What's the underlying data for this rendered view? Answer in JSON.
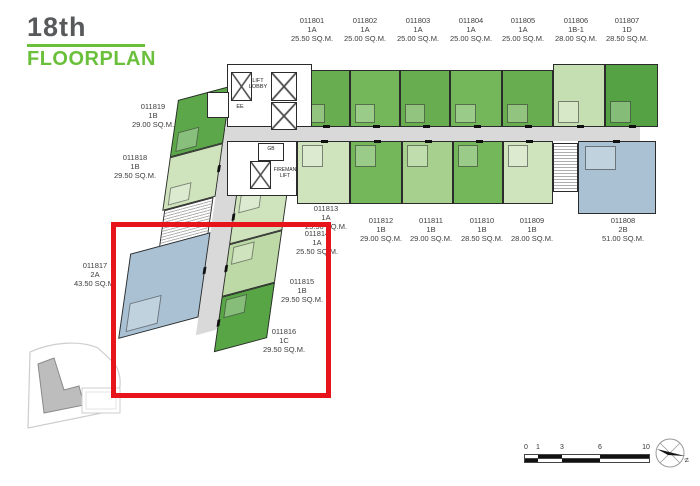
{
  "title": {
    "floor": "18th",
    "label": "FLOORPLAN"
  },
  "palette": {
    "highlight_red": "#e8141c",
    "brand_green": "#6abf3b",
    "title_gray": "#58595b",
    "unit_green_dark": "#5ca74a",
    "unit_green_mid": "#74b75a",
    "unit_green_pale": "#cfe4bd",
    "unit_blue_gray": "#a9c1d3",
    "corridor_gray": "#d9d9d9"
  },
  "units": [
    {
      "id": "011801",
      "type": "1A",
      "area": "25.50 SQ.M."
    },
    {
      "id": "011802",
      "type": "1A",
      "area": "25.00 SQ.M."
    },
    {
      "id": "011803",
      "type": "1A",
      "area": "25.00 SQ.M."
    },
    {
      "id": "011804",
      "type": "1A",
      "area": "25.00 SQ.M."
    },
    {
      "id": "011805",
      "type": "1A",
      "area": "25.00 SQ.M."
    },
    {
      "id": "011806",
      "type": "1B-1",
      "area": "28.00 SQ.M."
    },
    {
      "id": "011807",
      "type": "1D",
      "area": "28.50 SQ.M."
    },
    {
      "id": "011808",
      "type": "2B",
      "area": "51.00 SQ.M."
    },
    {
      "id": "011809",
      "type": "1B",
      "area": "28.00 SQ.M."
    },
    {
      "id": "011810",
      "type": "1B",
      "area": "28.50 SQ.M."
    },
    {
      "id": "011811",
      "type": "1B",
      "area": "29.00 SQ.M."
    },
    {
      "id": "011812",
      "type": "1B",
      "area": "29.00 SQ.M."
    },
    {
      "id": "011813",
      "type": "1A",
      "area": "25.50 SQ.M."
    },
    {
      "id": "011814",
      "type": "1A",
      "area": "25.50 SQ.M."
    },
    {
      "id": "011815",
      "type": "1B",
      "area": "29.50 SQ.M."
    },
    {
      "id": "011816",
      "type": "1C",
      "area": "29.50 SQ.M."
    },
    {
      "id": "011817",
      "type": "2A",
      "area": "43.50 SQ.M."
    },
    {
      "id": "011818",
      "type": "1B",
      "area": "29.50 SQ.M."
    },
    {
      "id": "011819",
      "type": "1B",
      "area": "29.00 SQ.M."
    }
  ],
  "annotations": {
    "lift_lobby_line1": "LIFT",
    "lift_lobby_line2": "LOBBY",
    "ee": "EE",
    "gb": "GB",
    "fireman_line1": "FIREMAN",
    "fireman_line2": "LIFT"
  },
  "scale_bar": {
    "ticks": [
      "0",
      "1",
      "3",
      "6",
      "10"
    ]
  },
  "compass": {
    "label": "N"
  }
}
